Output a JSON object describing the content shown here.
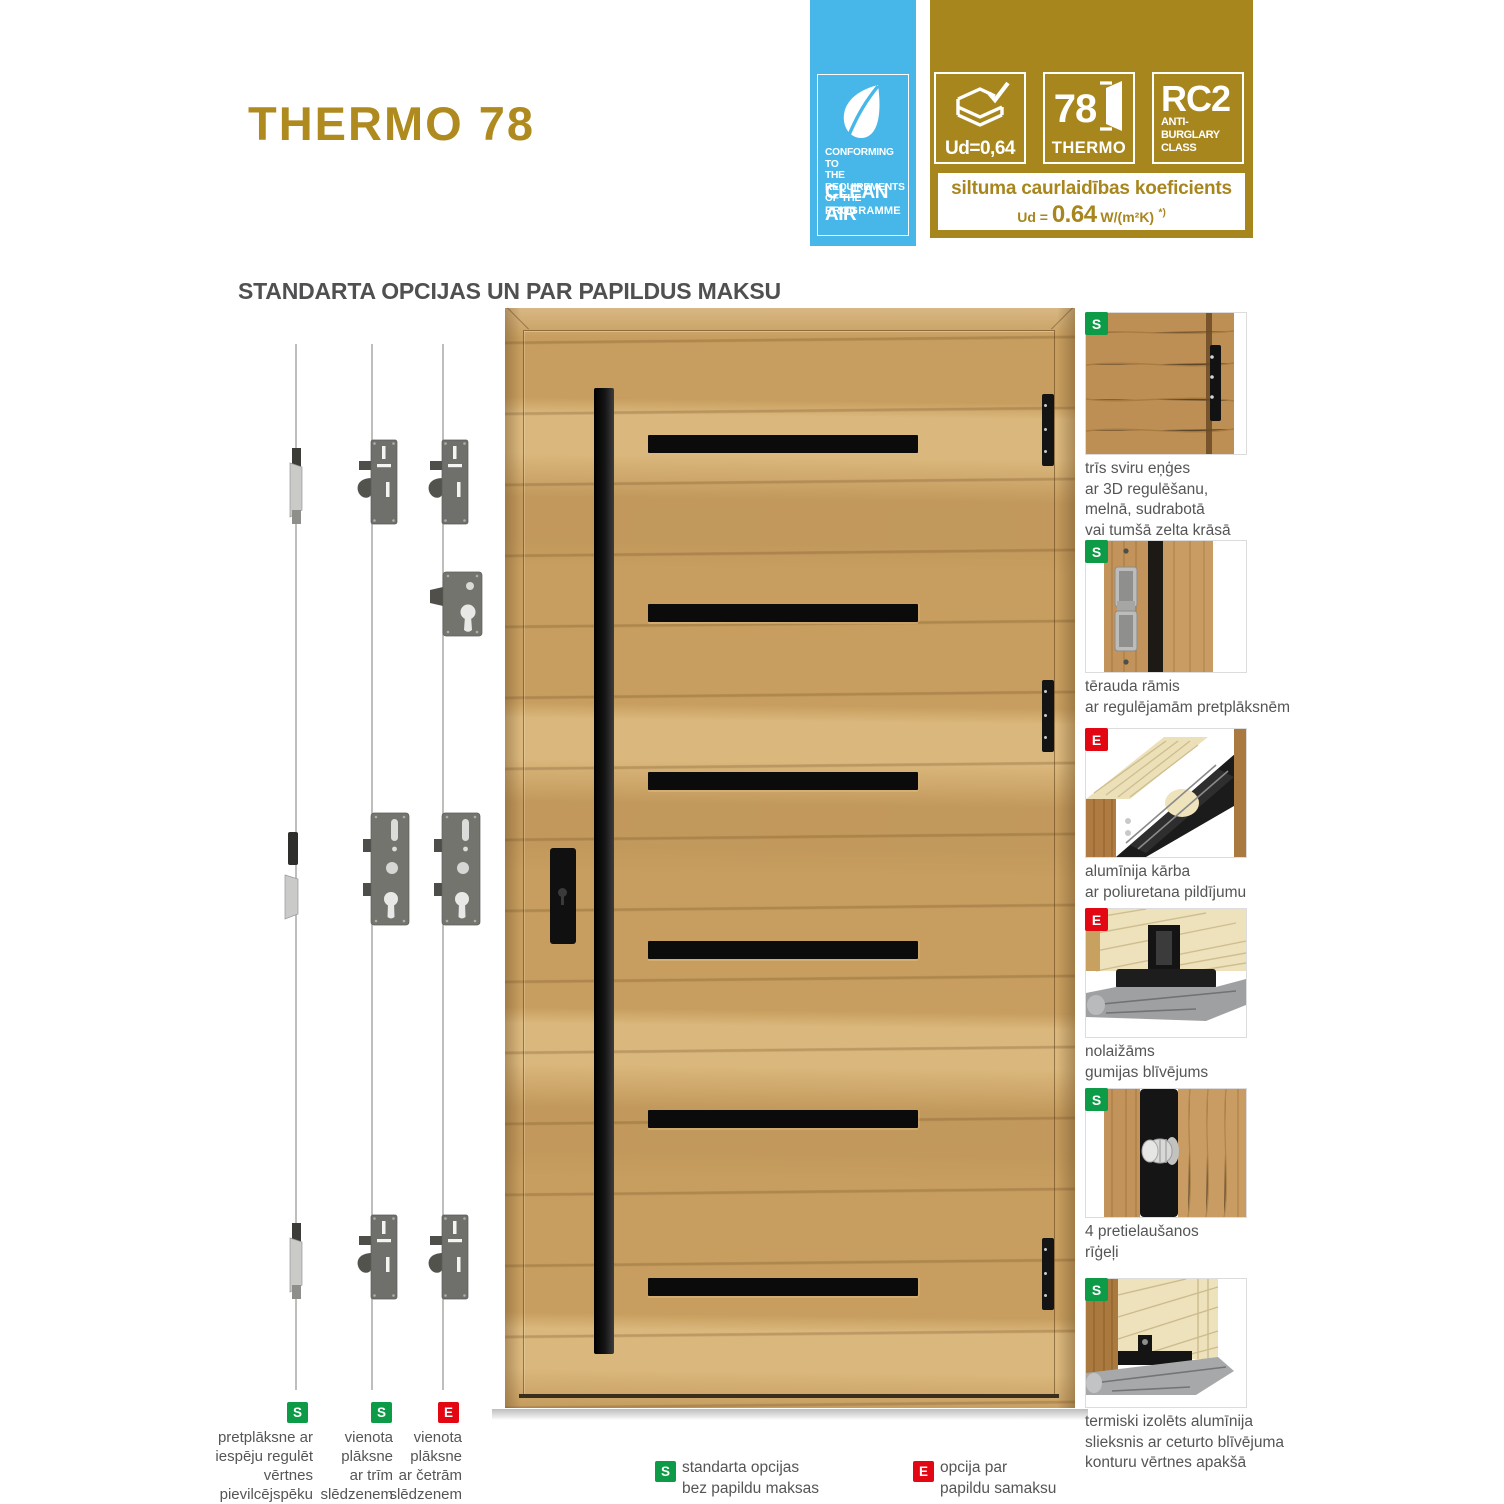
{
  "page": {
    "title": "THERMO 78",
    "section_heading": "STANDARTA OPCIJAS UN PAR PAPILDUS MAKSU"
  },
  "colors": {
    "gold": "#A8861E",
    "blue": "#47B7E9",
    "green": "#0D9B48",
    "red": "#E30613"
  },
  "clean_air_badge": {
    "small_lines": [
      "CONFORMING TO",
      "THE REQUIREMENTS",
      "OF THE"
    ],
    "big_line": "CLEAN AIR",
    "last_line": "PROGRAMME"
  },
  "gold_badge": {
    "ud_box": {
      "label": "Ud=0,64"
    },
    "thermo_box": {
      "number": "78",
      "label": "THERMO"
    },
    "rc_box": {
      "title": "RC2",
      "line1": "ANTI-BURGLARY",
      "line2": "CLASS"
    },
    "strip": {
      "line1": "siltuma caurlaidības koeficients",
      "prefix": "Ud = ",
      "value": "0.64",
      "unit": " W/(m²K)",
      "footnote": "*)"
    }
  },
  "lock_columns": [
    {
      "badge": "S",
      "label_lines": [
        "pretplāksne ar",
        "iespēju regulēt",
        "vērtnes",
        "pievilcējspēku"
      ]
    },
    {
      "badge": "S",
      "label_lines": [
        "vienota",
        "plāksne",
        "ar trīm",
        "slēdzenem"
      ]
    },
    {
      "badge": "E",
      "label_lines": [
        "vienota",
        "plāksne",
        "ar četrām",
        "slēdzenem"
      ]
    }
  ],
  "features": [
    {
      "badge": "S",
      "caption_lines": [
        "trīs sviru eņģes",
        "ar 3D regulēšanu,",
        "melnā, sudrabotā",
        "vai tumšā zelta krāsā"
      ]
    },
    {
      "badge": "S",
      "caption_lines": [
        "tērauda rāmis",
        "ar regulējamām pretplāksnēm"
      ]
    },
    {
      "badge": "E",
      "caption_lines": [
        "alumīnija kārba",
        "ar poliuretana pildījumu"
      ]
    },
    {
      "badge": "E",
      "caption_lines": [
        "nolaižāms",
        "gumijas blīvējums"
      ]
    },
    {
      "badge": "S",
      "caption_lines": [
        "4 pretielaušanos",
        "rīģeļi"
      ]
    },
    {
      "badge": "S",
      "caption_lines": [
        "termiski izolēts alumīnija",
        "slieksnis ar ceturto blīvējuma",
        "konturu vērtnes apakšā"
      ]
    }
  ],
  "legend": [
    {
      "badge": "S",
      "lines": [
        "standarta opcijas",
        "bez papildu maksas"
      ]
    },
    {
      "badge": "E",
      "lines": [
        "opcija par",
        "papildu samaksu"
      ]
    }
  ]
}
